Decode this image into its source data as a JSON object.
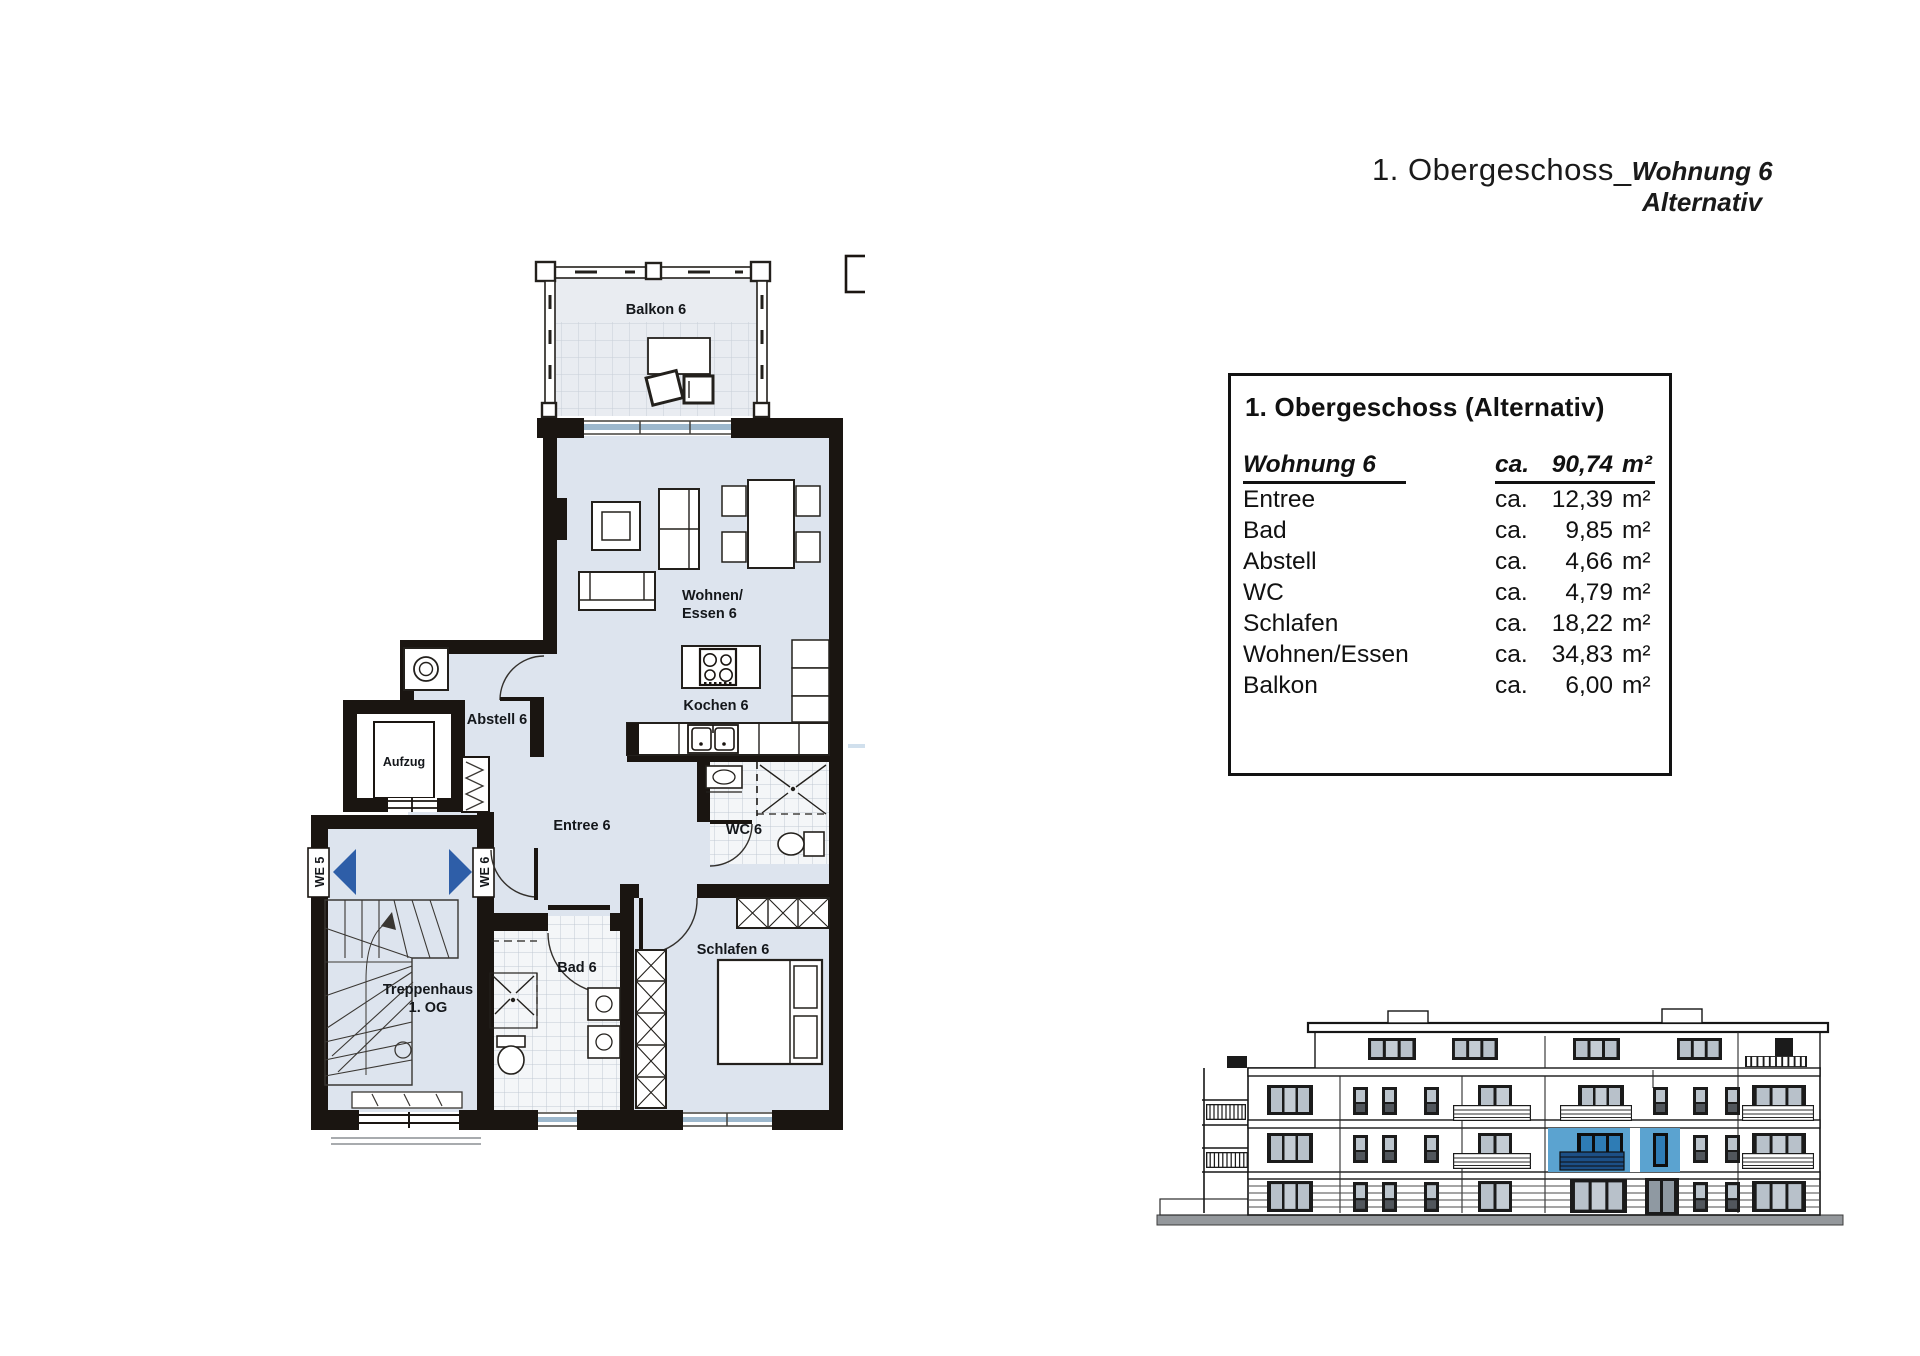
{
  "document": {
    "title": {
      "prefix": "1. Obergeschoss_",
      "line1": "Wohnung 6",
      "line2": "Alternativ"
    },
    "area_table": {
      "heading": "1. Obergeschoss (Alternativ)",
      "header_row": {
        "label": "Wohnung 6",
        "prefix": "ca.",
        "value": "90,74",
        "unit": "m²"
      },
      "rows": [
        {
          "label": "Entree",
          "prefix": "ca.",
          "value": "12,39",
          "unit": "m²"
        },
        {
          "label": "Bad",
          "prefix": "ca.",
          "value": "9,85",
          "unit": "m²"
        },
        {
          "label": "Abstell",
          "prefix": "ca.",
          "value": "4,66",
          "unit": "m²"
        },
        {
          "label": "WC",
          "prefix": "ca.",
          "value": "4,79",
          "unit": "m²"
        },
        {
          "label": "Schlafen",
          "prefix": "ca.",
          "value": "18,22",
          "unit": "m²"
        },
        {
          "label": "Wohnen/Essen",
          "prefix": "ca.",
          "value": "34,83",
          "unit": "m²"
        },
        {
          "label": "Balkon",
          "prefix": "ca.",
          "value": "6,00",
          "unit": "m²"
        }
      ]
    },
    "floor_plan": {
      "labels": {
        "balkon": "Balkon 6",
        "wohnen_line1": "Wohnen/",
        "wohnen_line2": "Essen 6",
        "kochen": "Kochen 6",
        "abstell": "Abstell 6",
        "aufzug": "Aufzug",
        "entree": "Entree 6",
        "wc": "WC 6",
        "bad": "Bad 6",
        "schlafen": "Schlafen 6",
        "treppenhaus_line1": "Treppenhaus",
        "treppenhaus_line2": "1. OG",
        "we5": "WE 5",
        "we6": "WE 6"
      },
      "colors": {
        "floor": "#dde4ee",
        "wall": "#1a1511",
        "direction_arrow": "#2e5ea8",
        "window_glazing": "#9db8cd",
        "highlight_unit": "#5ba3d0",
        "highlight_window": "#2e7cb5"
      }
    }
  }
}
